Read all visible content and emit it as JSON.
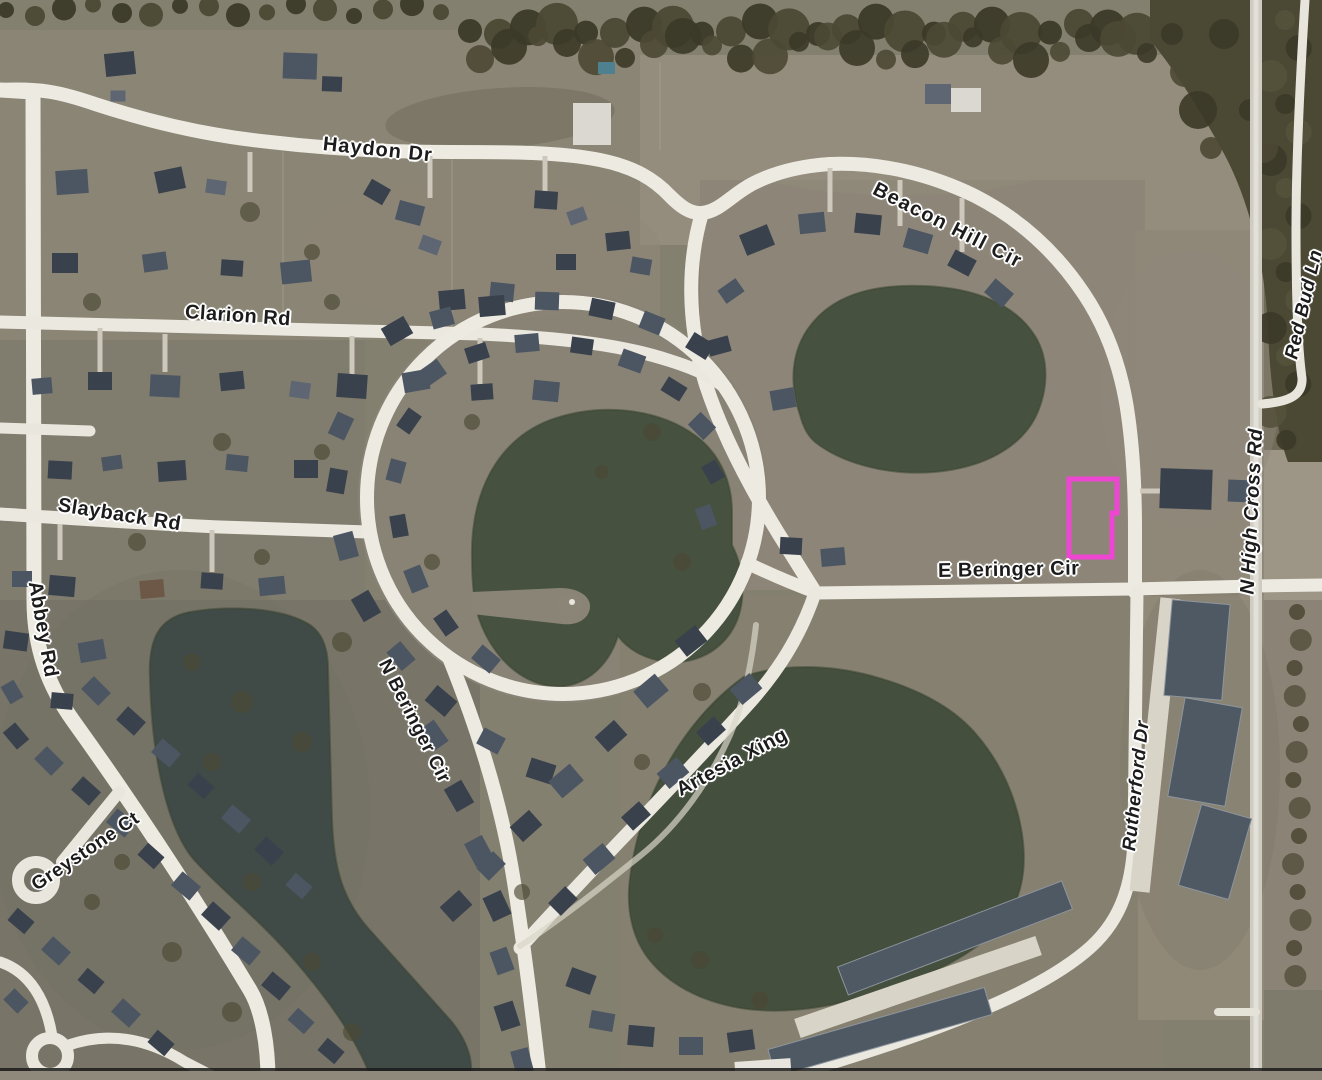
{
  "map": {
    "roads": {
      "haydon": "Haydon Dr",
      "beacon": "Beacon Hill Cir",
      "clarion": "Clarion Rd",
      "slayback": "Slayback Rd",
      "abbey": "Abbey Rd",
      "e_beringer": "E Beringer Cir",
      "n_beringer": "N Beringer Cir",
      "artesia": "Artesia Xing",
      "greystone": "Greystone Ct",
      "rutherford": "Rutherford Dr",
      "high_cross": "N High Cross Rd",
      "red_bud": "Red Bud Ln"
    },
    "highlight": {
      "shape": "parcel-outline",
      "color": "#ee46d2"
    },
    "colors": {
      "land_base": "#84806f",
      "land_light": "#948d7c",
      "land_dark": "#73705f",
      "road": "#edeae2",
      "road_gray": "#d2cfc6",
      "water": "#46523f",
      "water_teal": "#404b47",
      "water_se": "#444f3e",
      "tree": "#4b4834",
      "tree_dark": "#3b3927",
      "roof_dark": "#39414d",
      "roof_mid": "#4c5663",
      "roof_light": "#5d6672",
      "roof_brown": "#6d5848",
      "roof_white": "#dad8d0",
      "driveway": "#cdc8bb",
      "townhouse": "#4f5963",
      "label_text": "#1c1c1c",
      "label_halo": "#ffffff"
    }
  }
}
